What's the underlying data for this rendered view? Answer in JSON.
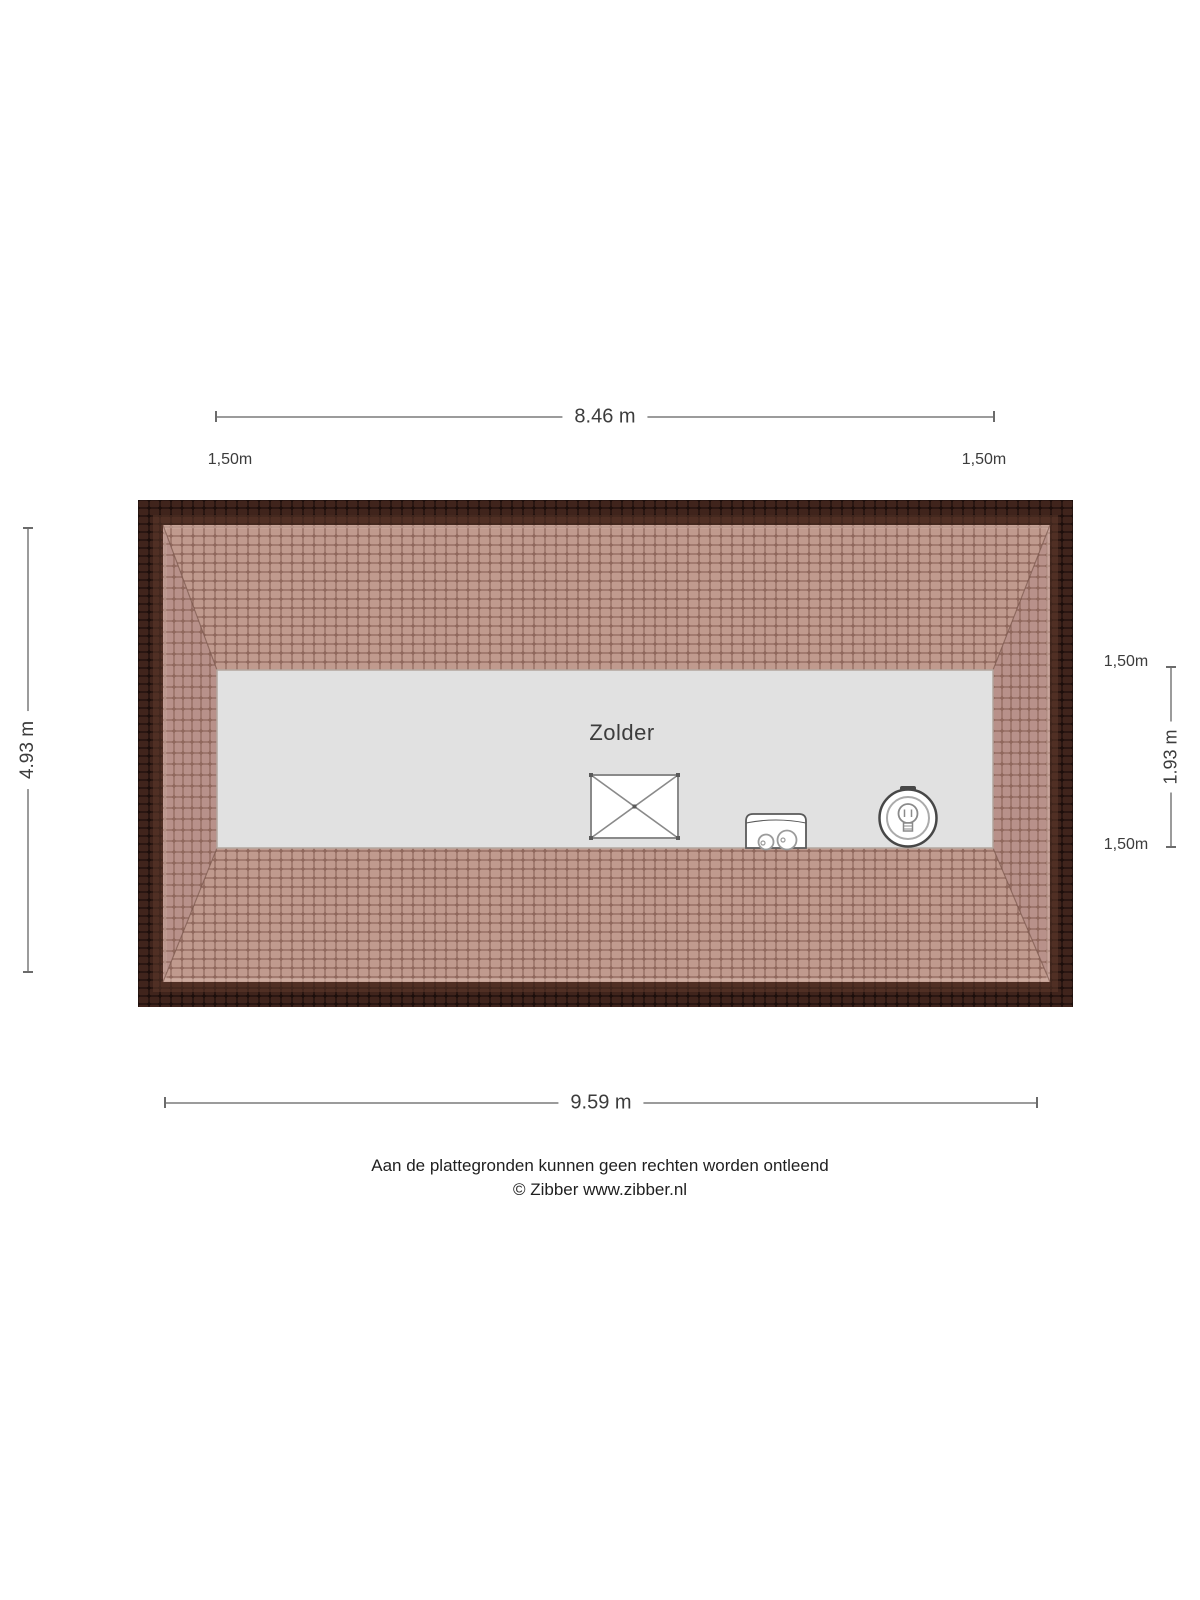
{
  "plan": {
    "room_label": "Zolder"
  },
  "dimensions": {
    "top": {
      "label": "8.46 m"
    },
    "bottom": {
      "label": "9.59 m"
    },
    "left": {
      "label": "4.93 m"
    },
    "right_height": {
      "label": "1.93 m"
    },
    "knee_walls": {
      "top_left": "1,50m",
      "top_right": "1,50m",
      "right_upper": "1,50m",
      "right_lower": "1,50m"
    }
  },
  "icons": [
    "roof-window-icon",
    "boiler-unit-icon",
    "light-bulb-icon"
  ],
  "footer": {
    "disclaimer": "Aan de plattegronden kunnen geen rechten worden ontleend",
    "credit": "© Zibber www.zibber.nl"
  },
  "colors": {
    "roof_border_tile": "#40241c",
    "roof_border_mortar": "#1c0e0b",
    "roof_slope_tile": "#c09a8e",
    "roof_slope_tile_side": "#b8918a",
    "roof_slope_mortar": "#8f675c",
    "attic_floor": "#e1e1e1",
    "dimension_line": "#9b9b9b",
    "text": "#3c3c3c"
  }
}
